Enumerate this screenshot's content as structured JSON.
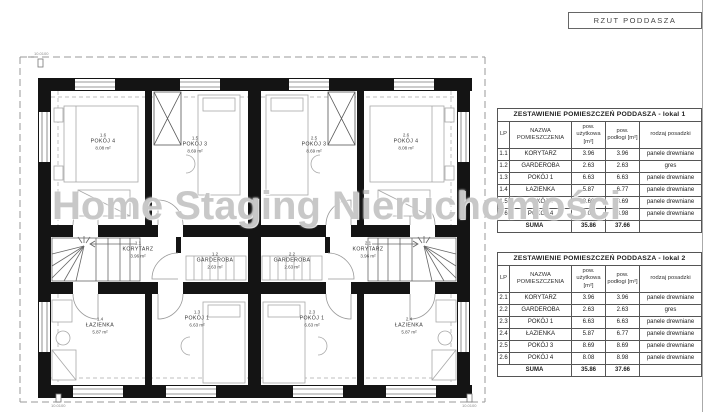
{
  "title_block": {
    "label": "RZUT PODDASZA"
  },
  "watermark": "Home Staging Nieruchomości",
  "corner_mark_label": "10.0100",
  "plan": {
    "rooms": [
      {
        "id": "1.6",
        "name": "POKÓJ 4",
        "area": "8.08 m²",
        "x": 85,
        "y": 92
      },
      {
        "id": "1.5",
        "name": "POKÓJ 3",
        "area": "8.69 m²",
        "x": 177,
        "y": 95
      },
      {
        "id": "2.5",
        "name": "POKÓJ 3",
        "area": "8.69 m²",
        "x": 296,
        "y": 95
      },
      {
        "id": "2.6",
        "name": "POKÓJ 4",
        "area": "8.08 m²",
        "x": 388,
        "y": 92
      },
      {
        "id": "1.1",
        "name": "KORYTARZ",
        "area": "3.96 m²",
        "x": 120,
        "y": 200
      },
      {
        "id": "1.2",
        "name": "GARDEROBA",
        "area": "2.63 m²",
        "x": 197,
        "y": 211
      },
      {
        "id": "2.2",
        "name": "GARDEROBA",
        "area": "2.63 m²",
        "x": 274,
        "y": 211
      },
      {
        "id": "2.1",
        "name": "KORYTARZ",
        "area": "3.96 m²",
        "x": 350,
        "y": 200
      },
      {
        "id": "1.4",
        "name": "ŁAZIENKA",
        "area": "5.87 m²",
        "x": 82,
        "y": 276
      },
      {
        "id": "1.3",
        "name": "POKÓJ 1",
        "area": "6.63 m²",
        "x": 179,
        "y": 269
      },
      {
        "id": "2.3",
        "name": "POKÓJ 1",
        "area": "6.63 m²",
        "x": 294,
        "y": 269
      },
      {
        "id": "2.4",
        "name": "ŁAZIENKA",
        "area": "5.87 m²",
        "x": 391,
        "y": 276
      }
    ]
  },
  "tables": [
    {
      "title": "ZESTAWIENIE POMIESZCZEŃ PODDASZA - lokal 1",
      "headers": {
        "lp": "LP",
        "name": "NAZWA POMIESZCZENIA",
        "usable": "pow. użytkowa [m²]",
        "floor": "pow. podłogi [m²]",
        "finish": "rodzaj posadzki"
      },
      "rows": [
        [
          "1.1",
          "KORYTARZ",
          "3.96",
          "3.96",
          "panele drewniane"
        ],
        [
          "1.2",
          "GARDEROBA",
          "2.63",
          "2.63",
          "gres"
        ],
        [
          "1.3",
          "POKÓJ 1",
          "6.63",
          "6.63",
          "panele drewniane"
        ],
        [
          "1.4",
          "ŁAZIENKA",
          "5.87",
          "6.77",
          "panele drewniane"
        ],
        [
          "1.5",
          "POKÓJ 3",
          "8.69",
          "8.69",
          "panele drewniane"
        ],
        [
          "1.6",
          "POKÓJ 4",
          "8.08",
          "8.98",
          "panele drewniane"
        ]
      ],
      "suma": {
        "label": "SUMA",
        "usable": "35.86",
        "floor": "37.66"
      }
    },
    {
      "title": "ZESTAWIENIE POMIESZCZEŃ PODDASZA - lokal 2",
      "headers": {
        "lp": "LP",
        "name": "NAZWA POMIESZCZENIA",
        "usable": "pow. użytkowa [m²]",
        "floor": "pow. podłogi [m²]",
        "finish": "rodzaj posadzki"
      },
      "rows": [
        [
          "2.1",
          "KORYTARZ",
          "3.96",
          "3.96",
          "panele drewniane"
        ],
        [
          "2.2",
          "GARDEROBA",
          "2.63",
          "2.63",
          "gres"
        ],
        [
          "2.3",
          "POKÓJ 1",
          "6.63",
          "6.63",
          "panele drewniane"
        ],
        [
          "2.4",
          "ŁAZIENKA",
          "5.87",
          "6.77",
          "panele drewniane"
        ],
        [
          "2.5",
          "POKÓJ 3",
          "8.69",
          "8.69",
          "panele drewniane"
        ],
        [
          "2.6",
          "POKÓJ 4",
          "8.08",
          "8.98",
          "panele drewniane"
        ]
      ],
      "suma": {
        "label": "SUMA",
        "usable": "35.86",
        "floor": "37.66"
      }
    }
  ]
}
